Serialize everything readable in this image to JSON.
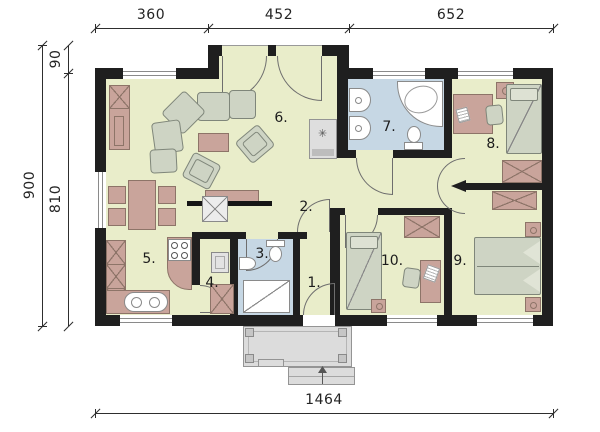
{
  "dimensions": {
    "top": [
      "360",
      "452",
      "652"
    ],
    "left": {
      "outer": "900",
      "inner_top": "90",
      "inner_bottom": "810"
    },
    "bottom": "1464"
  },
  "room_labels": [
    "1.",
    "2.",
    "3.",
    "4.",
    "5.",
    "6.",
    "7.",
    "8.",
    "9.",
    "10."
  ],
  "symbols": {
    "fireplace": "✳"
  },
  "colors": {
    "wall": "#1f1f1f",
    "floor": "#e9edca",
    "bath_floor": "#c6d7e4",
    "tan": "#c9a49b",
    "tan_border": "#8d7468",
    "gray": "#ced4c4",
    "gray_border": "#7f867a",
    "porch": "#dcdcdc",
    "line": "#2e2e2e"
  }
}
